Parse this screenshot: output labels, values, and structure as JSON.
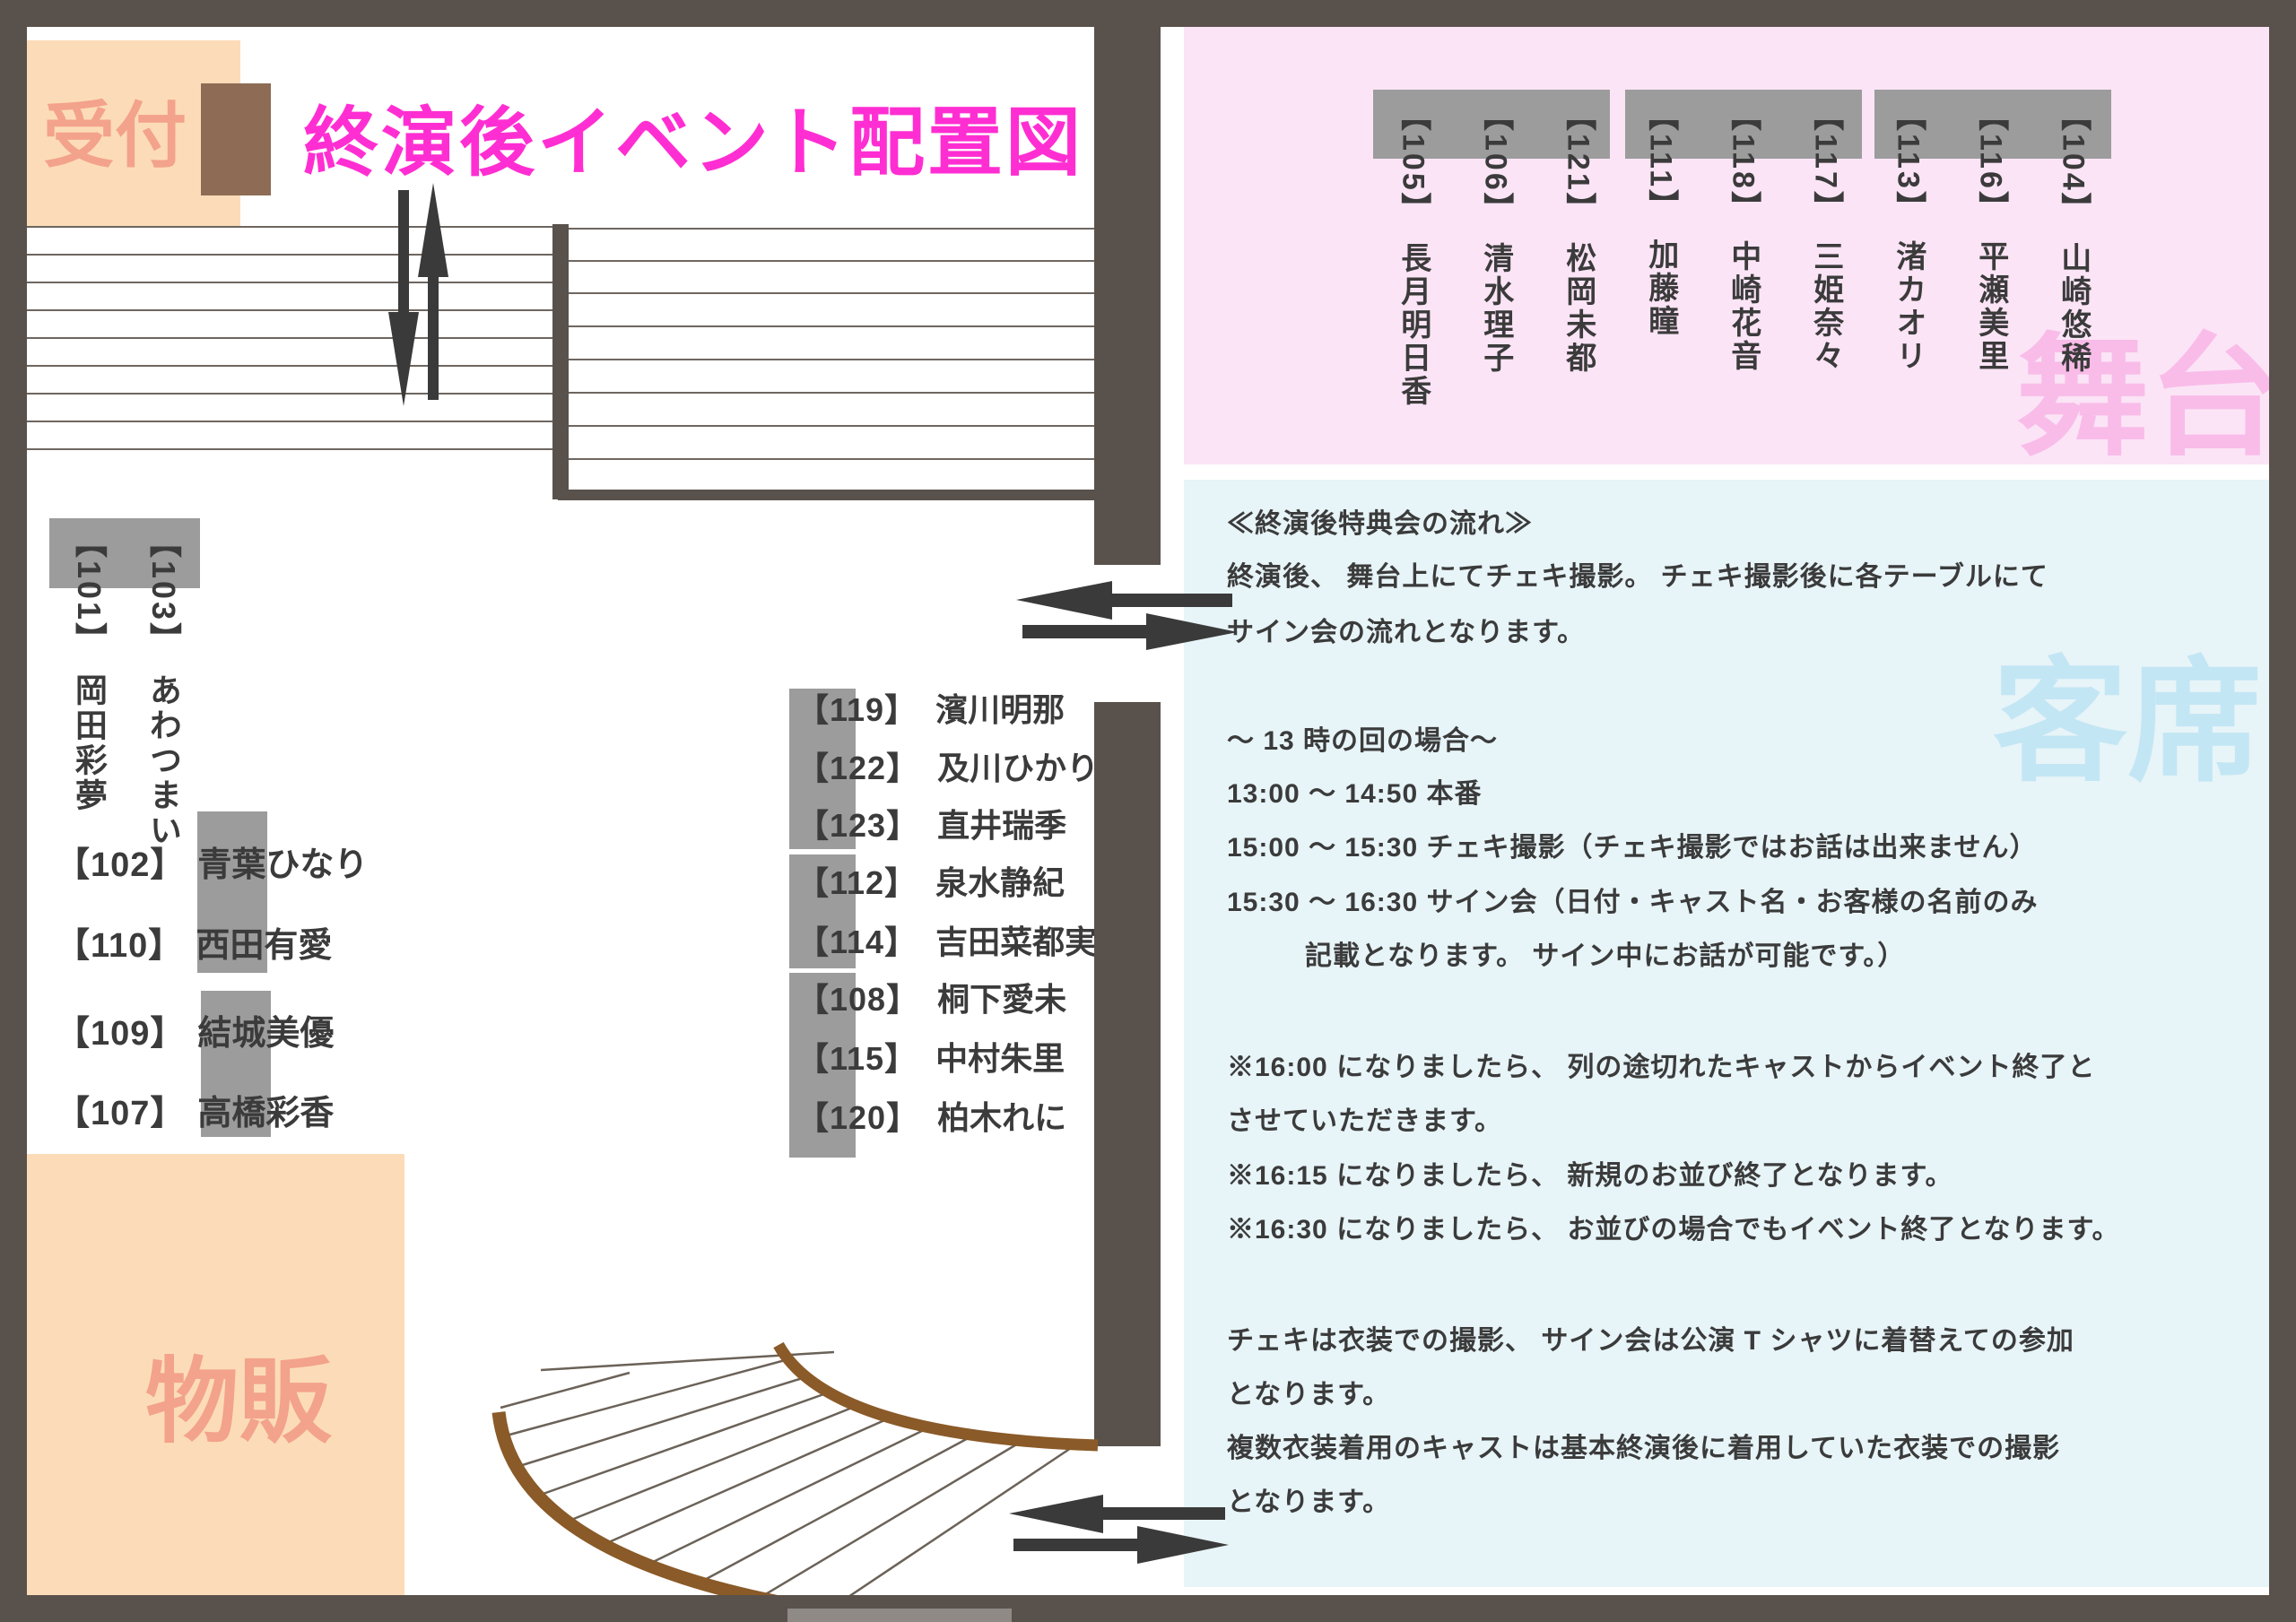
{
  "title": "終演後イベント配置図",
  "zones": {
    "reception": "受付",
    "merch": "物販",
    "stage": "舞台",
    "audience": "客席"
  },
  "stage_casts": [
    {
      "no": "【105】",
      "name": "長月明日香"
    },
    {
      "no": "【106】",
      "name": "清水理子"
    },
    {
      "no": "【121】",
      "name": "松岡未都"
    },
    {
      "no": "【111】",
      "name": "加藤瞳"
    },
    {
      "no": "【118】",
      "name": "中崎花音"
    },
    {
      "no": "【117】",
      "name": "三姫奈々"
    },
    {
      "no": "【113】",
      "name": "渚カオリ"
    },
    {
      "no": "【116】",
      "name": "平瀬美里"
    },
    {
      "no": "【104】",
      "name": "山崎悠稀"
    }
  ],
  "wall_casts": [
    {
      "no": "【103】",
      "name": "あわつまい"
    },
    {
      "no": "【101】",
      "name": "岡田彩夢"
    }
  ],
  "left_casts": [
    {
      "no": "【102】",
      "name": "青葉ひなり"
    },
    {
      "no": "【110】",
      "name": "西田有愛"
    },
    {
      "no": "【109】",
      "name": "結城美優"
    },
    {
      "no": "【107】",
      "name": "高橋彩香"
    }
  ],
  "middle_casts": [
    {
      "no": "【119】",
      "name": "濱川明那"
    },
    {
      "no": "【122】",
      "name": "及川ひかり"
    },
    {
      "no": "【123】",
      "name": "直井瑞季"
    },
    {
      "no": "【112】",
      "name": "泉水静紀"
    },
    {
      "no": "【114】",
      "name": "吉田菜都実"
    },
    {
      "no": "【108】",
      "name": "桐下愛未"
    },
    {
      "no": "【115】",
      "name": "中村朱里"
    },
    {
      "no": "【120】",
      "name": "柏木れに"
    }
  ],
  "notes": {
    "lines": [
      "≪終演後特典会の流れ≫",
      "終演後、 舞台上にてチェキ撮影。 チェキ撮影後に各テーブルにて",
      "サイン会の流れとなります。",
      "～ 13 時の回の場合～",
      "13:00 ～ 14:50 本番",
      "15:00 ～ 15:30 チェキ撮影（チェキ撮影ではお話は出来ません）",
      "15:30 ～ 16:30 サイン会（日付・キャスト名・お客様の名前のみ",
      "記載となります。 サイン中にお話が可能です。）",
      "※16:00 になりましたら、 列の途切れたキャストからイベント終了と",
      "させていただきます。",
      "※16:15 になりましたら、 新規のお並び終了となります。",
      "※16:30 になりましたら、 お並びの場合でもイベント終了となります。",
      "チェキは衣装での撮影、 サイン会は公演 T シャツに着替えての参加",
      "となります。",
      "複数衣装着用のキャストは基本終演後に着用していた衣装での撮影",
      "となります。"
    ]
  },
  "colors": {
    "frame": "#59514b",
    "title": "#ff2ed2",
    "peach_zone": "#fcdcb8",
    "peach_text": "#f3a28b",
    "stage_zone": "#fbe4f6",
    "stage_text": "#f9bce9",
    "audience_zone": "#e7f4f8",
    "audience_text": "#c3e6f4",
    "table_gray": "#9c9c9c",
    "queue_brown": "#8a5a28",
    "arrow_dark": "#3a3a3a"
  }
}
